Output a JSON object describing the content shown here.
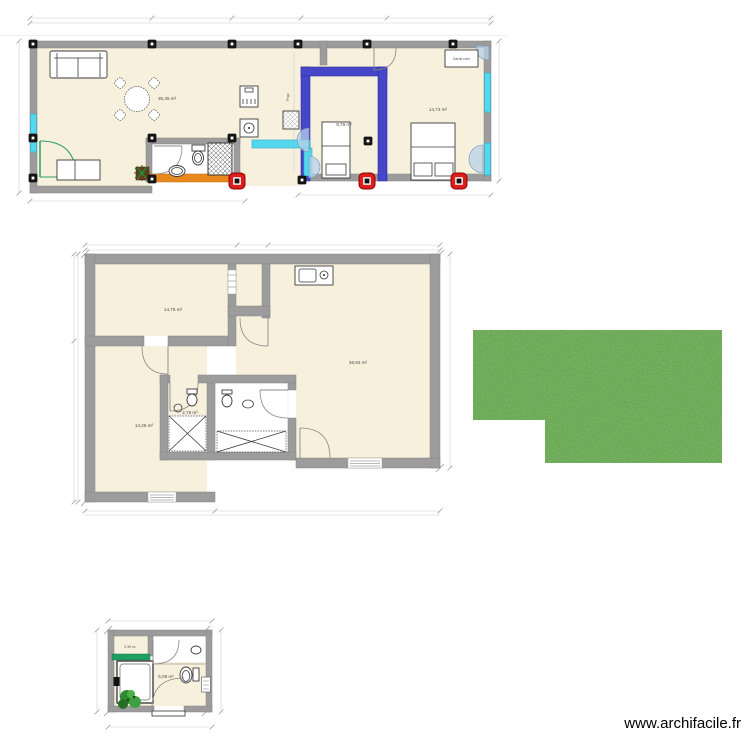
{
  "watermark": "www.archifacile.fr",
  "colors": {
    "wall": "#9c9c9c",
    "room_fill": "#f7f0dc",
    "selected_wall_blue": "#4646c8",
    "selected_wall_orange": "#e8891f",
    "window_cyan": "#55d8ee",
    "door_green": "#2aa06a",
    "handle_red": "#dd1c1c",
    "grass_green": "#56a246"
  },
  "plan_top": {
    "rooms": [
      {
        "id": "room-living",
        "area_label": "35,35 m²"
      },
      {
        "id": "room-bedroom-1",
        "area_label": "9,78 m²"
      },
      {
        "id": "room-bedroom-2",
        "area_label": "14,73 m²"
      }
    ],
    "furniture_labels": {
      "fridge": "Frigo",
      "wardrobe": "Garde robe"
    }
  },
  "plan_middle": {
    "rooms": [
      {
        "id": "room-top-left",
        "area_label": "14,76 m²"
      },
      {
        "id": "room-main",
        "area_label": "36,93 m²"
      },
      {
        "id": "room-bottom-left",
        "area_label": "14,26 m²"
      },
      {
        "id": "room-bath-small",
        "area_label": "2,76 m²"
      }
    ]
  },
  "plan_bottom": {
    "rooms": [
      {
        "id": "room-closet",
        "area_label": "0,39 m²"
      },
      {
        "id": "room-cabin",
        "area_label": "5,08 m²"
      }
    ]
  }
}
